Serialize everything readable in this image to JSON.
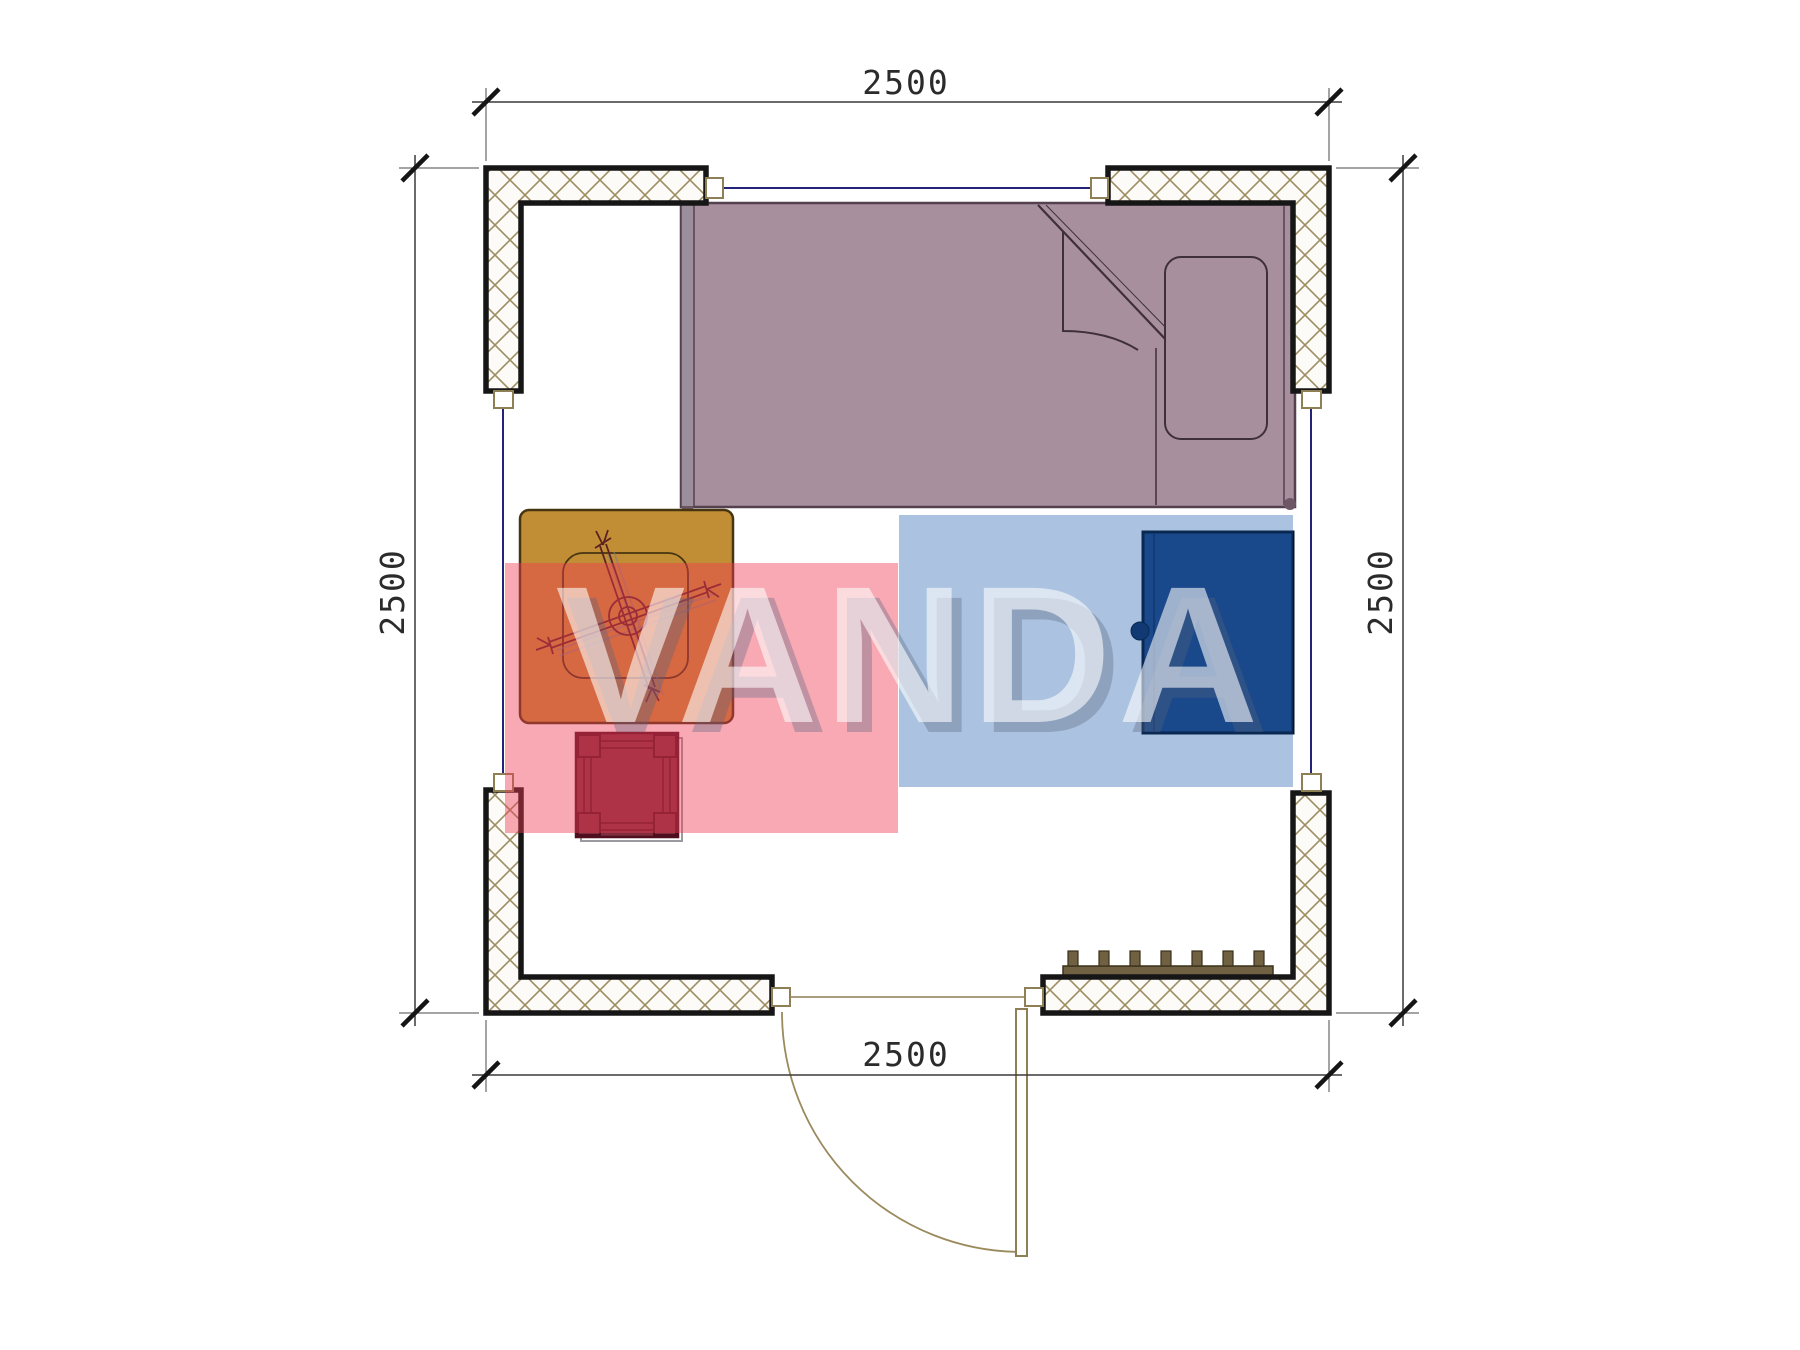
{
  "plan": {
    "type": "floor-plan",
    "dimensions": {
      "top": "2500",
      "bottom": "2500",
      "left": "2500",
      "right": "2500"
    },
    "watermark": {
      "text": "VANDA"
    },
    "objects": {
      "bed": "single-bed",
      "table": "table-with-fan",
      "stool": "stool",
      "wardrobe": "wardrobe",
      "radiator": "radiator",
      "door": "swing-door",
      "window_top": "window",
      "window_left": "window",
      "window_right": "window"
    },
    "colors": {
      "bed": "#a78f9e",
      "bed_frame": "#9b8e9d",
      "table": "#c28e35",
      "stool": "#7e2e3c",
      "wardrobe": "#24477f",
      "radiator": "#6f6142",
      "hatch_line": "#9c8d62",
      "wall_outline": "#161616",
      "window_glass": "#23237a",
      "door_line": "#9a8a5e",
      "watermark_pink": "#ee3c55",
      "watermark_blue": "#0a50a5"
    }
  }
}
